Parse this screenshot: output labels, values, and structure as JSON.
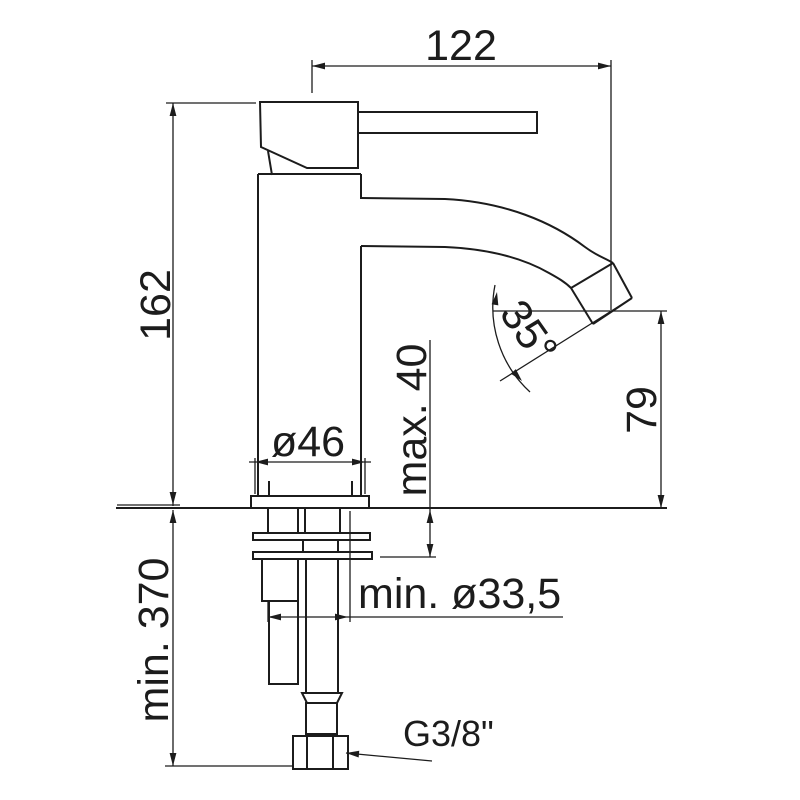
{
  "drawing": {
    "background_color": "#ffffff",
    "line_color": "#1c1c1c",
    "labels": {
      "spout_reach": "122",
      "body_height": "162",
      "base_diameter": "ø46",
      "max_deck_thickness": "max. 40",
      "spout_angle": "35°",
      "outlet_height": "79",
      "min_hole_diameter": "min. ø33,5",
      "min_clearance_below": "min. 370",
      "supply_connection": "G3/8\""
    }
  }
}
